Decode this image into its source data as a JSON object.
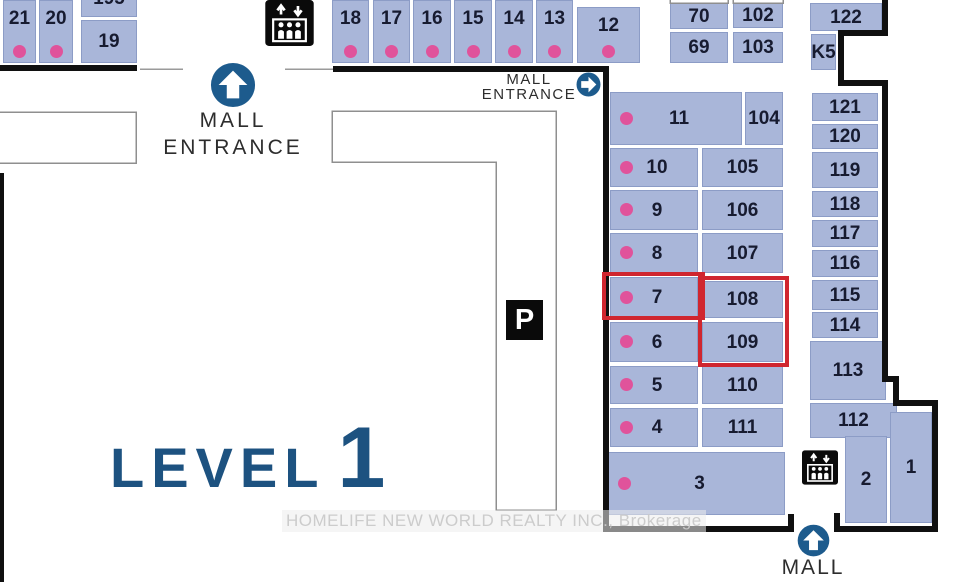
{
  "map": {
    "level_word": "LEVEL",
    "level_number": "1",
    "watermark": "HOMELIFE NEW WORLD REALTY INC., Brokerage",
    "entrance_top_left": {
      "line1": "MALL",
      "line2": "ENTRANCE"
    },
    "entrance_top_right": {
      "line1": "MALL",
      "line2": "ENTRANCE"
    },
    "entrance_bottom": {
      "label": "MALL"
    },
    "parking_label": "P"
  },
  "colors": {
    "unit_fill": "#a9b6d9",
    "unit_border": "#8c9cc6",
    "dot_pink": "#e0539b",
    "wall_black": "#101010",
    "icon_blue": "#1d5b8d",
    "level_blue": "#1d5280",
    "highlight_red": "#d0262f",
    "number_text": "#171b30"
  },
  "icons": {
    "entrance_top_left": "up-arrow-circle",
    "entrance_top_right": "right-arrow-circle",
    "entrance_bottom": "up-arrow-circle",
    "elevator_top": "elevator-pictogram",
    "elevator_bottom_right": "elevator-pictogram",
    "parking": "parking-square"
  },
  "highlights": [
    {
      "x": 602,
      "y": 272,
      "w": 103,
      "h": 48
    },
    {
      "x": 698,
      "y": 276,
      "w": 91,
      "h": 91
    }
  ],
  "units": [
    {
      "label": "21",
      "x": 3,
      "y": 0,
      "w": 33,
      "h": 63,
      "dot": true,
      "variant": "v"
    },
    {
      "label": "20",
      "x": 39,
      "y": 0,
      "w": 34,
      "h": 63,
      "dot": true,
      "variant": "v"
    },
    {
      "label": "195",
      "x": 81,
      "y": -21,
      "w": 56,
      "h": 38,
      "dot": false,
      "variant": "plain"
    },
    {
      "label": "19",
      "x": 81,
      "y": 20,
      "w": 56,
      "h": 43,
      "dot": false,
      "variant": "plain"
    },
    {
      "label": "18",
      "x": 332,
      "y": 0,
      "w": 37,
      "h": 63,
      "dot": true,
      "variant": "v"
    },
    {
      "label": "17",
      "x": 373,
      "y": 0,
      "w": 37,
      "h": 63,
      "dot": true,
      "variant": "v"
    },
    {
      "label": "16",
      "x": 413,
      "y": 0,
      "w": 38,
      "h": 63,
      "dot": true,
      "variant": "v"
    },
    {
      "label": "15",
      "x": 454,
      "y": 0,
      "w": 38,
      "h": 63,
      "dot": true,
      "variant": "v"
    },
    {
      "label": "14",
      "x": 495,
      "y": 0,
      "w": 38,
      "h": 63,
      "dot": true,
      "variant": "v"
    },
    {
      "label": "13",
      "x": 536,
      "y": 0,
      "w": 37,
      "h": 63,
      "dot": true,
      "variant": "v"
    },
    {
      "label": "12",
      "x": 577,
      "y": 7,
      "w": 63,
      "h": 56,
      "dot": true,
      "variant": "v"
    },
    {
      "label": "70",
      "x": 670,
      "y": 3,
      "w": 58,
      "h": 26,
      "dot": false,
      "variant": "plain"
    },
    {
      "label": "102",
      "x": 733,
      "y": 2,
      "w": 50,
      "h": 26,
      "dot": false,
      "variant": "plain"
    },
    {
      "label": "69",
      "x": 670,
      "y": 32,
      "w": 58,
      "h": 31,
      "dot": false,
      "variant": "plain"
    },
    {
      "label": "103",
      "x": 733,
      "y": 32,
      "w": 50,
      "h": 31,
      "dot": false,
      "variant": "plain"
    },
    {
      "label": "122",
      "x": 810,
      "y": 3,
      "w": 72,
      "h": 28,
      "dot": false,
      "variant": "plain"
    },
    {
      "label": "K5",
      "x": 811,
      "y": 34,
      "w": 25,
      "h": 36,
      "dot": false,
      "variant": "plain"
    },
    {
      "label": "11",
      "x": 610,
      "y": 92,
      "w": 132,
      "h": 53,
      "dot": true,
      "variant": "h"
    },
    {
      "label": "104",
      "x": 745,
      "y": 92,
      "w": 38,
      "h": 53,
      "dot": false,
      "variant": "plain"
    },
    {
      "label": "10",
      "x": 610,
      "y": 148,
      "w": 88,
      "h": 39,
      "dot": true,
      "variant": "h"
    },
    {
      "label": "105",
      "x": 702,
      "y": 148,
      "w": 81,
      "h": 39,
      "dot": false,
      "variant": "plain"
    },
    {
      "label": "9",
      "x": 610,
      "y": 190,
      "w": 88,
      "h": 40,
      "dot": true,
      "variant": "h"
    },
    {
      "label": "106",
      "x": 702,
      "y": 190,
      "w": 81,
      "h": 40,
      "dot": false,
      "variant": "plain"
    },
    {
      "label": "8",
      "x": 610,
      "y": 233,
      "w": 88,
      "h": 40,
      "dot": true,
      "variant": "h"
    },
    {
      "label": "107",
      "x": 702,
      "y": 233,
      "w": 81,
      "h": 40,
      "dot": false,
      "variant": "plain"
    },
    {
      "label": "7",
      "x": 610,
      "y": 277,
      "w": 88,
      "h": 41,
      "dot": true,
      "variant": "h"
    },
    {
      "label": "108",
      "x": 702,
      "y": 281,
      "w": 81,
      "h": 37,
      "dot": false,
      "variant": "plain"
    },
    {
      "label": "6",
      "x": 610,
      "y": 322,
      "w": 88,
      "h": 40,
      "dot": true,
      "variant": "h"
    },
    {
      "label": "109",
      "x": 702,
      "y": 322,
      "w": 81,
      "h": 40,
      "dot": false,
      "variant": "plain"
    },
    {
      "label": "5",
      "x": 610,
      "y": 366,
      "w": 88,
      "h": 38,
      "dot": true,
      "variant": "h"
    },
    {
      "label": "110",
      "x": 702,
      "y": 366,
      "w": 81,
      "h": 38,
      "dot": false,
      "variant": "plain"
    },
    {
      "label": "4",
      "x": 610,
      "y": 408,
      "w": 88,
      "h": 39,
      "dot": true,
      "variant": "h"
    },
    {
      "label": "111",
      "x": 702,
      "y": 408,
      "w": 81,
      "h": 39,
      "dot": false,
      "variant": "plain"
    },
    {
      "label": "3",
      "x": 608,
      "y": 452,
      "w": 177,
      "h": 63,
      "dot": true,
      "variant": "h"
    },
    {
      "label": "121",
      "x": 812,
      "y": 93,
      "w": 66,
      "h": 28,
      "dot": false,
      "variant": "plain"
    },
    {
      "label": "120",
      "x": 812,
      "y": 124,
      "w": 66,
      "h": 25,
      "dot": false,
      "variant": "plain"
    },
    {
      "label": "119",
      "x": 812,
      "y": 152,
      "w": 66,
      "h": 36,
      "dot": false,
      "variant": "plain"
    },
    {
      "label": "118",
      "x": 812,
      "y": 191,
      "w": 66,
      "h": 26,
      "dot": false,
      "variant": "plain"
    },
    {
      "label": "117",
      "x": 812,
      "y": 220,
      "w": 66,
      "h": 27,
      "dot": false,
      "variant": "plain"
    },
    {
      "label": "116",
      "x": 812,
      "y": 250,
      "w": 66,
      "h": 27,
      "dot": false,
      "variant": "plain"
    },
    {
      "label": "115",
      "x": 812,
      "y": 280,
      "w": 66,
      "h": 30,
      "dot": false,
      "variant": "plain"
    },
    {
      "label": "114",
      "x": 812,
      "y": 312,
      "w": 66,
      "h": 26,
      "dot": false,
      "variant": "plain"
    },
    {
      "label": "113",
      "x": 810,
      "y": 341,
      "w": 76,
      "h": 59,
      "dot": false,
      "variant": "plain"
    },
    {
      "label": "112",
      "x": 810,
      "y": 403,
      "w": 87,
      "h": 35,
      "dot": false,
      "variant": "plain"
    },
    {
      "label": "2",
      "x": 845,
      "y": 436,
      "w": 42,
      "h": 87,
      "dot": false,
      "variant": "plain"
    },
    {
      "label": "1",
      "x": 890,
      "y": 412,
      "w": 42,
      "h": 111,
      "dot": false,
      "variant": "plain"
    }
  ]
}
